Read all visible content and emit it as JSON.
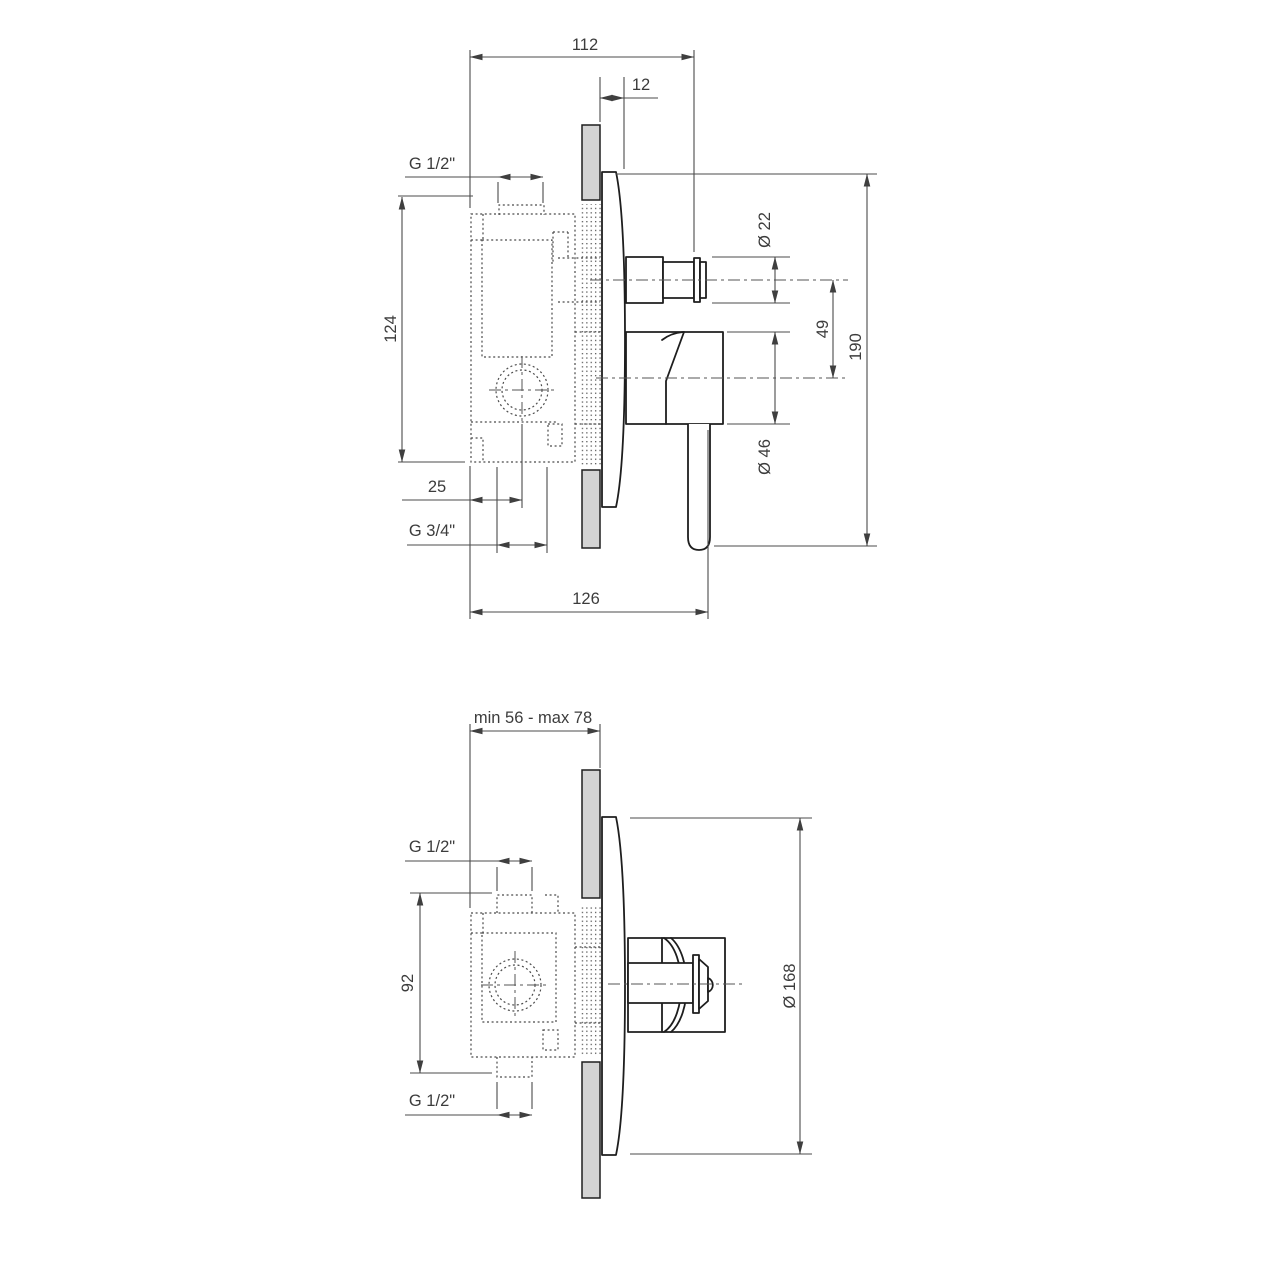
{
  "drawing": {
    "title": "concealed-shower-mixer-technical-drawing",
    "colors": {
      "background": "#ffffff",
      "outline": "#1e1e1e",
      "dimension_line": "#4b4b4b",
      "text": "#3c3c3c",
      "wall_fill": "#d3d3d3"
    },
    "upper_view": {
      "name": "side-section-view",
      "dims": {
        "width_overall": "112",
        "plate_offset": "12",
        "inlet_thread": "G 1/2\"",
        "body_height": "124",
        "center_offset": "25",
        "outlet_thread": "G 3/4\"",
        "depth_overall": "126",
        "knob_diameter": "Ø 22",
        "axis_distance": "49",
        "height_overall": "190",
        "handle_diameter": "Ø 46"
      }
    },
    "lower_view": {
      "name": "side-section-view-rotated",
      "dims": {
        "recess_depth_range": "min 56 - max 78",
        "inlet_thread_top": "G 1/2\"",
        "body_height": "92",
        "inlet_thread_bottom": "G 1/2\"",
        "plate_diameter": "Ø 168"
      }
    }
  }
}
